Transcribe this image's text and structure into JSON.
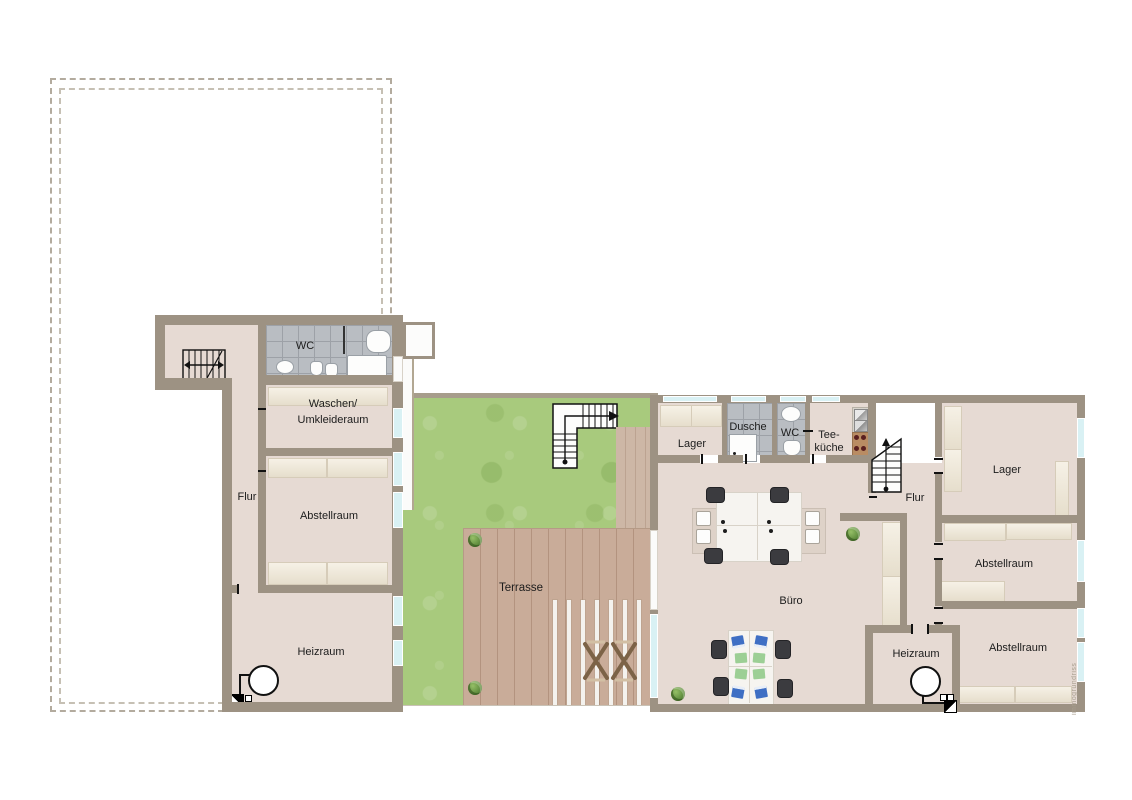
{
  "watermark": "immogrundriss",
  "colors": {
    "wall": "#9d9283",
    "floor": "#e6dad3",
    "tile_gray": "#b9bdc2",
    "lawn_green": "#a8ca7d",
    "deck_wood": "#c9ac99",
    "window_glass": "#d9f1f4",
    "stair_lines": "#111111",
    "chair_dark": "#3b3b3f",
    "laptop_blue": "#3f6fc4",
    "paper_green": "#9ccf95"
  },
  "left_building": {
    "wc": "WC",
    "waschen_line1": "Waschen/",
    "waschen_line2": "Umkleideraum",
    "flur": "Flur",
    "abstellraum": "Abstellraum",
    "heizraum": "Heizraum"
  },
  "outdoor": {
    "terrasse": "Terrasse"
  },
  "right_building": {
    "lager_top": "Lager",
    "dusche": "Dusche",
    "wc": "WC",
    "teekueche_line1": "Tee-",
    "teekueche_line2": "küche",
    "flur": "Flur",
    "buero": "Büro",
    "lager_east": "Lager",
    "abstellraum_1": "Abstellraum",
    "abstellraum_2": "Abstellraum",
    "heizraum": "Heizraum"
  }
}
